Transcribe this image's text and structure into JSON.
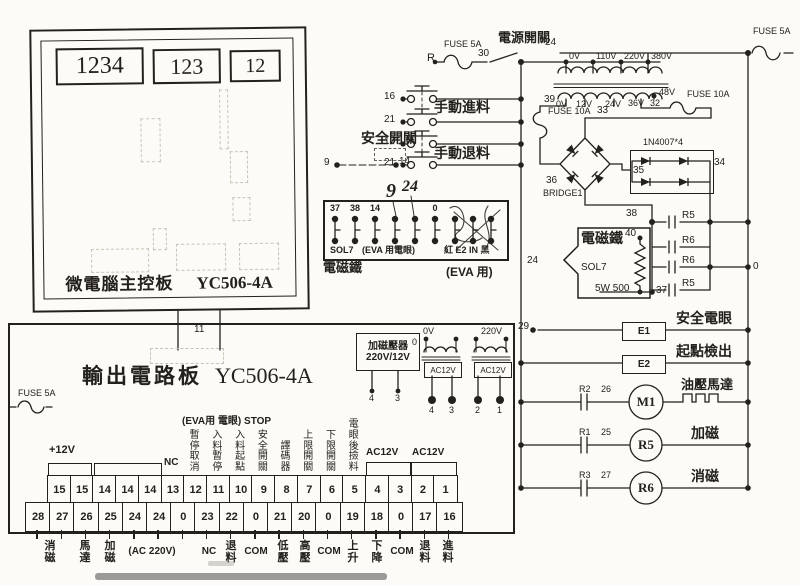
{
  "main_board": {
    "title": "微電腦主控板",
    "model": "YC506-4A",
    "displays": [
      "1234",
      "123",
      "12"
    ]
  },
  "board_link": {
    "label": "11"
  },
  "power": {
    "fuse_left": "FUSE 5A",
    "r_label": "R",
    "wire_30": "30",
    "switch_label": "電源開關",
    "wire_24_top": "24",
    "bus_24": "24",
    "fuse_right_top": "FUSE 5A",
    "transformer": {
      "primary_taps": [
        "0V",
        "110V",
        "220V",
        "380V"
      ],
      "secondary_taps": [
        "0V",
        "12V",
        "24V",
        "36V",
        "48V"
      ],
      "wire_39": "39",
      "wire_32": "32",
      "wire_33": "33",
      "fuse_10a_left": "FUSE 10A",
      "fuse_10a_right": "FUSE 10A"
    }
  },
  "buttons": {
    "rows": [
      {
        "num": "16"
      },
      {
        "num": "21"
      },
      {
        "num": "17"
      },
      {
        "num": "21"
      }
    ],
    "feed_label": "手動進料",
    "retract_label": "手動退料",
    "safety_label": "安全開關",
    "safety_from": "9",
    "safety_to": "14",
    "hw_9": "9",
    "hw_24": "24"
  },
  "sol_block": {
    "top_labels": [
      "37",
      "38",
      "14",
      "",
      "",
      "0",
      "",
      "",
      ""
    ],
    "sol_label": "SOL7",
    "eva_label": "(EVA 用電眼)",
    "scribble_label": "紅 E2 IN 黑",
    "below_left": "電磁鐵",
    "below_right": "(EVA 用)"
  },
  "rectifier": {
    "bridge_num": "36",
    "bridge_label": "BRIDGE1",
    "diode_label": "1N4007*4",
    "node_35": "35",
    "node_34": "34"
  },
  "magnet": {
    "name": "電磁鐵",
    "sol": "SOL7",
    "resistor": "5W 500",
    "n38": "38",
    "n40": "40",
    "n37": "37",
    "caps": [
      "R5",
      "R6",
      "R6",
      "R5"
    ],
    "wire_0": "0"
  },
  "outputs": {
    "rows": [
      {
        "wire": "29",
        "device": "E1",
        "label": "安全電眼"
      },
      {
        "device": "E2",
        "label": "起點檢出"
      },
      {
        "contact": "R2",
        "wire": "26",
        "device": "M1",
        "label": "油壓馬達"
      },
      {
        "contact": "R1",
        "wire": "25",
        "device": "R5",
        "label": "加磁"
      },
      {
        "contact": "R3",
        "wire": "27",
        "device": "R6",
        "label": "消磁"
      }
    ]
  },
  "output_board": {
    "title": "輸出電路板",
    "model": "YC506-4A",
    "fuse_label": "FUSE 5A",
    "plus12v_label": "+12V",
    "nc_label": "NC",
    "eva_header": "(EVA用 電眼) STOP",
    "column_labels": [
      "暫停取消",
      "入料暫停",
      "入料起點",
      "安全開關",
      "譯碼器",
      "上限開關",
      "下限開關",
      "電眼後撿料"
    ],
    "ac12v_labels": [
      "AC12V",
      "AC12V"
    ],
    "top_row": [
      "15",
      "15",
      "14",
      "14",
      "14",
      "13",
      "12",
      "11",
      "10",
      "9",
      "8",
      "7",
      "6",
      "5",
      "4",
      "3",
      "2",
      "1"
    ],
    "bottom_row": [
      "28",
      "27",
      "26",
      "25",
      "24",
      "24",
      "0",
      "23",
      "22",
      "0",
      "21",
      "20",
      "0",
      "19",
      "18",
      "0",
      "17",
      "16"
    ],
    "bottom_labels": [
      "消磁",
      "馬達",
      "加磁",
      "(AC 220V)",
      "NC",
      "退料",
      "COM",
      "低壓",
      "高壓",
      "COM",
      "上升",
      "下降",
      "COM",
      "退料",
      "進料"
    ]
  },
  "magnet_transformer": {
    "line1": "加磁壓器",
    "line2": "220V/12V",
    "terminals": [
      "4",
      "3"
    ]
  },
  "mini_transformers": {
    "zero_label": "0",
    "primary_labels": [
      "0V",
      "220V"
    ],
    "secondary_labels": [
      "AC12V",
      "AC12V"
    ],
    "output_terminals": [
      "4",
      "3",
      "2",
      "1"
    ]
  }
}
